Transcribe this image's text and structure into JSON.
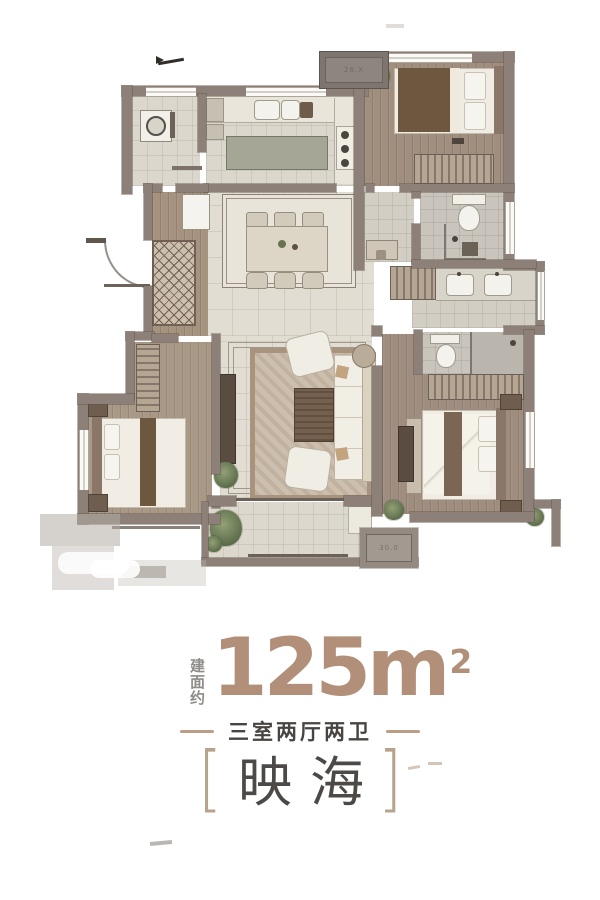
{
  "footer": {
    "area_label": "建面约",
    "area_number": "125m",
    "area_sup": "2",
    "subtitle": "三室两厅两卫",
    "bracket_left": "[",
    "name": "映海",
    "bracket_right": "]"
  },
  "plan": {
    "ac_plate_top_label": "26.X",
    "ac_plate_bottom_label": "30.0"
  },
  "colors": {
    "accent_tan": "#b18f78",
    "dash_tan": "#bd9e85",
    "bracket_tan": "#b7a38c",
    "text_dark": "#484442",
    "label_gray": "#8f8d8a",
    "wall_taupe": "#8d8078"
  }
}
